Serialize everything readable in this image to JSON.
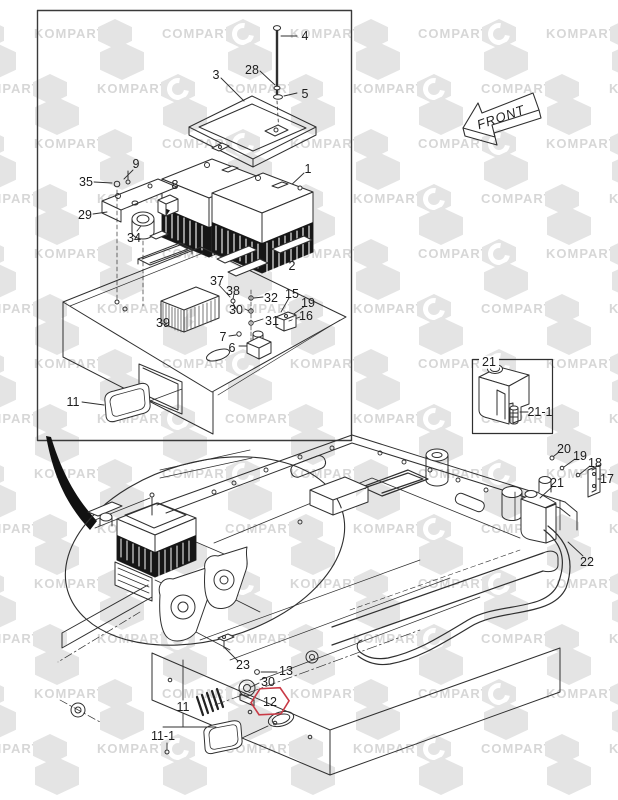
{
  "page": {
    "width": 618,
    "height": 800
  },
  "colors": {
    "line": "#2f2f2f",
    "highlight": "#c93a46",
    "watermark_fill": "#e4e4e4",
    "watermark_text": "#d7d7d7"
  },
  "watermark": {
    "word_left": "KOMPART",
    "word_right": "COMPART"
  },
  "front_arrow": {
    "label": "FRONT"
  },
  "callouts": [
    {
      "id": "4",
      "label": "4",
      "x": 305,
      "y": 36
    },
    {
      "id": "28",
      "label": "28",
      "x": 252,
      "y": 70
    },
    {
      "id": "5",
      "label": "5",
      "x": 305,
      "y": 94
    },
    {
      "id": "3",
      "label": "3",
      "x": 216,
      "y": 75
    },
    {
      "id": "1",
      "label": "1",
      "x": 308,
      "y": 169
    },
    {
      "id": "9",
      "label": "9",
      "x": 136,
      "y": 164
    },
    {
      "id": "35",
      "label": "35",
      "x": 86,
      "y": 182
    },
    {
      "id": "8",
      "label": "8",
      "x": 175,
      "y": 185
    },
    {
      "id": "29",
      "label": "29",
      "x": 85,
      "y": 215
    },
    {
      "id": "34",
      "label": "34",
      "x": 134,
      "y": 238
    },
    {
      "id": "2",
      "label": "2",
      "x": 292,
      "y": 266
    },
    {
      "id": "37",
      "label": "37",
      "x": 217,
      "y": 281
    },
    {
      "id": "38",
      "label": "38",
      "x": 233,
      "y": 291
    },
    {
      "id": "32",
      "label": "32",
      "x": 271,
      "y": 298
    },
    {
      "id": "15",
      "label": "15",
      "x": 292,
      "y": 294
    },
    {
      "id": "19-upper",
      "label": "19",
      "x": 308,
      "y": 303
    },
    {
      "id": "30-upper",
      "label": "30",
      "x": 236,
      "y": 310
    },
    {
      "id": "31",
      "label": "31",
      "x": 272,
      "y": 321
    },
    {
      "id": "16",
      "label": "16",
      "x": 306,
      "y": 316
    },
    {
      "id": "7",
      "label": "7",
      "x": 223,
      "y": 337
    },
    {
      "id": "6",
      "label": "6",
      "x": 232,
      "y": 348
    },
    {
      "id": "39",
      "label": "39",
      "x": 163,
      "y": 323
    },
    {
      "id": "11-box",
      "label": "11",
      "x": 73,
      "y": 402
    },
    {
      "id": "21-inset",
      "label": "21",
      "x": 489,
      "y": 362,
      "bg": true
    },
    {
      "id": "21-1",
      "label": "21-1",
      "x": 540,
      "y": 412
    },
    {
      "id": "20",
      "label": "20",
      "x": 564,
      "y": 449
    },
    {
      "id": "19-frame",
      "label": "19",
      "x": 580,
      "y": 456
    },
    {
      "id": "18",
      "label": "18",
      "x": 595,
      "y": 463
    },
    {
      "id": "17",
      "label": "17",
      "x": 607,
      "y": 479
    },
    {
      "id": "21-frame",
      "label": "21",
      "x": 557,
      "y": 483
    },
    {
      "id": "22",
      "label": "22",
      "x": 587,
      "y": 562
    },
    {
      "id": "23",
      "label": "23",
      "x": 243,
      "y": 665
    },
    {
      "id": "13",
      "label": "13",
      "x": 286,
      "y": 671
    },
    {
      "id": "30-frame",
      "label": "30",
      "x": 268,
      "y": 682
    },
    {
      "id": "12",
      "label": "12",
      "x": 270,
      "y": 702,
      "highlight": true
    },
    {
      "id": "11-frame",
      "label": "11",
      "x": 183,
      "y": 707
    },
    {
      "id": "11-1",
      "label": "11-1",
      "x": 163,
      "y": 736
    }
  ]
}
